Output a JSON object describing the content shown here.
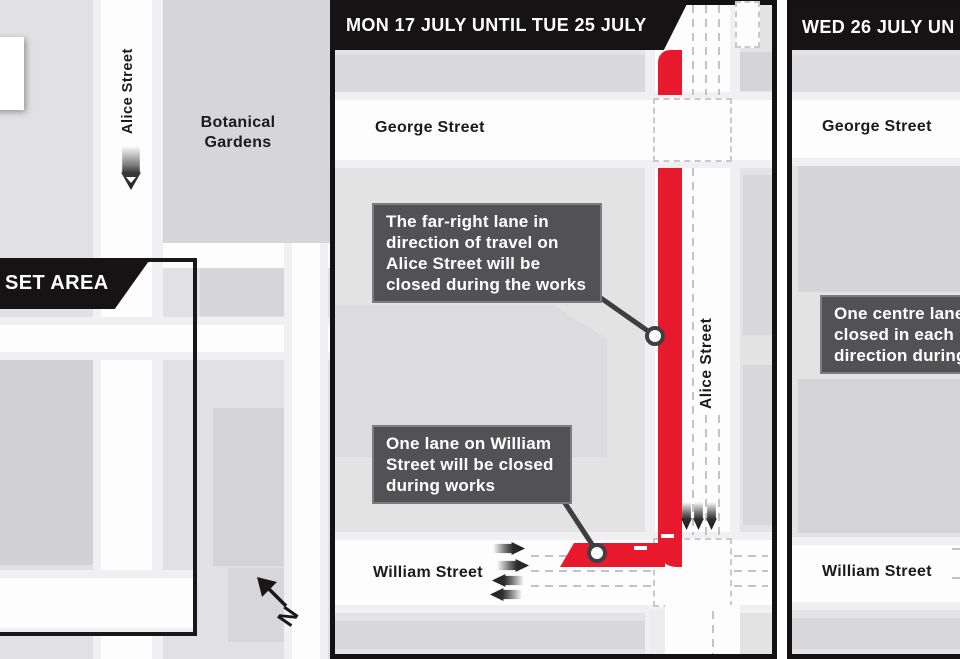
{
  "colors": {
    "closure_red": "#e8192c",
    "panel_black": "#161314",
    "callout_gray": "#525254",
    "map_background": "#e3e3e4",
    "road_white": "#fdfdfe"
  },
  "overview": {
    "alice_street": "Alice Street",
    "botanical_gardens": "Botanical Gardens",
    "inset_banner": "SET AREA",
    "north_label": "N"
  },
  "panels": {
    "mon": {
      "header": "MON 17 JULY UNTIL TUE 25 JULY",
      "george_street": "George Street",
      "alice_street": "Alice Street",
      "william_street": "William Street",
      "callout_alice": {
        "lines": [
          "The far-right lane in",
          "direction of travel on",
          "Alice Street will be",
          "closed during the works"
        ]
      },
      "callout_william": {
        "lines": [
          "One lane on William",
          "Street will be closed",
          "during works"
        ]
      }
    },
    "wed": {
      "header": "WED 26 JULY UN",
      "george_street": "George Street",
      "william_street": "William Street",
      "callout_centre": {
        "lines": [
          "One centre lane",
          "closed in each",
          "direction during"
        ]
      }
    }
  }
}
